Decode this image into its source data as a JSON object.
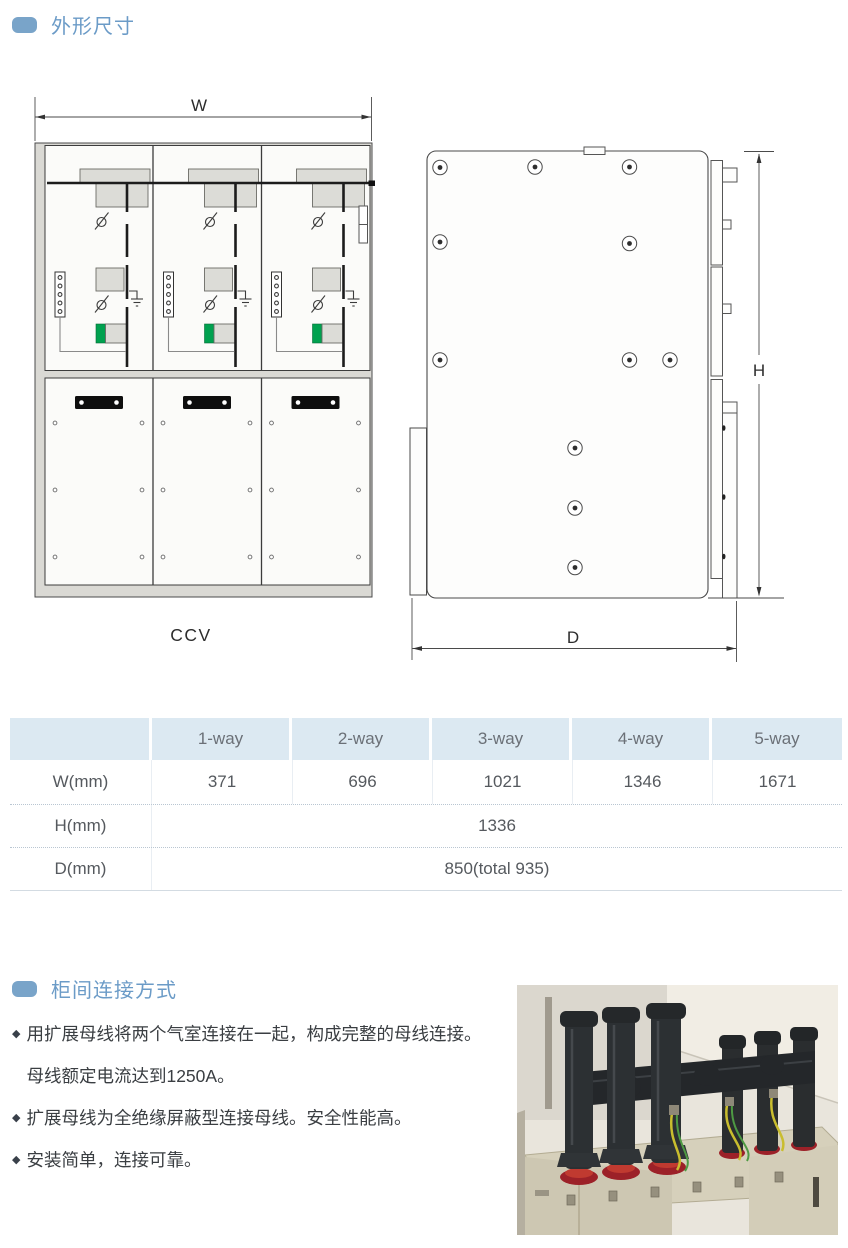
{
  "section1": {
    "title": "外形尺寸"
  },
  "diagram": {
    "front_view": {
      "dim_w": "W",
      "label": "CCV"
    },
    "side_view": {
      "dim_h": "H",
      "dim_d": "D"
    }
  },
  "table": {
    "columns": [
      "1-way",
      "2-way",
      "3-way",
      "4-way",
      "5-way"
    ],
    "rows": [
      {
        "label": "W(mm)",
        "values": [
          "371",
          "696",
          "1021",
          "1346",
          "1671"
        ]
      },
      {
        "label": "H(mm)",
        "merged": "1336"
      },
      {
        "label": "D(mm)",
        "merged": "850(total 935)"
      }
    ]
  },
  "section2": {
    "title": "柜间连接方式",
    "bullets": [
      {
        "lines": [
          "用扩展母线将两个气室连接在一起，构成完整的母线连接。",
          "母线额定电流达到1250A。"
        ]
      },
      {
        "lines": [
          "扩展母线为全绝缘屏蔽型连接母线。安全性能高。"
        ]
      },
      {
        "lines": [
          "安装简单，连接可靠。"
        ]
      }
    ]
  },
  "colors": {
    "accent_blue": "#6b9bc7",
    "table_header_bg": "#dce9f2",
    "diagram_green": "#00a14f"
  }
}
